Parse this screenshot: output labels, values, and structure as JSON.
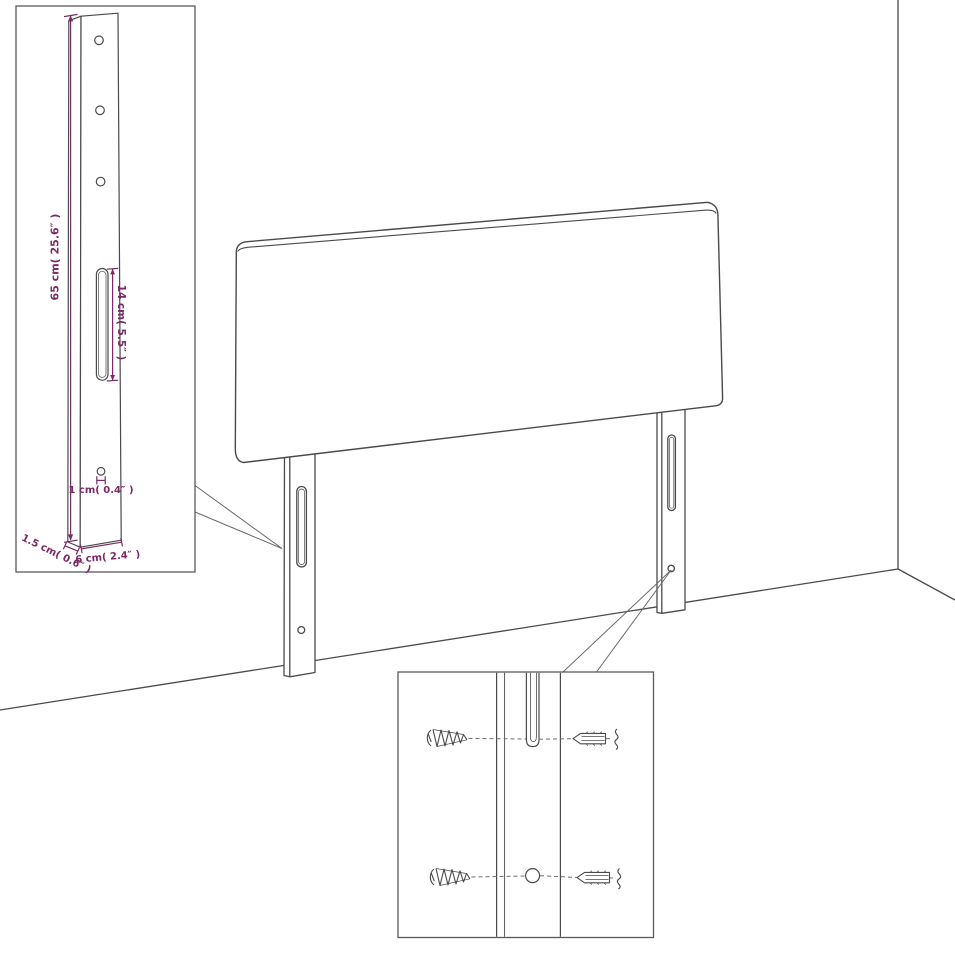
{
  "diagram": {
    "type": "furniture-assembly-line-drawing",
    "subject": "upholstered headboard with two wall-mount legs shown in a room corner",
    "colors": {
      "line": "#4a4a4a",
      "box_border": "#5a5a5a",
      "dash": "#6f6f6f",
      "annotation": "#7a2a66",
      "background": "#ffffff"
    },
    "leg_detail_inset": {
      "name": "leg dimension detail",
      "labels": {
        "leg_height": "65 cm( 25.6″ )",
        "slot_length": "14 cm( 5.5″ )",
        "hole_diameter": "1 cm( 0.4″ )",
        "leg_depth": "1.5 cm( 0.6″ )",
        "leg_width": "6 cm( 2.4″ )"
      },
      "features": [
        "three-screw-holes",
        "long-slot",
        "small-hole"
      ]
    },
    "mounting_detail_inset": {
      "name": "wall mounting detail",
      "parts": [
        "screw",
        "leg-slot",
        "wall-plug",
        "screw",
        "leg-hole",
        "wall-plug"
      ]
    }
  }
}
